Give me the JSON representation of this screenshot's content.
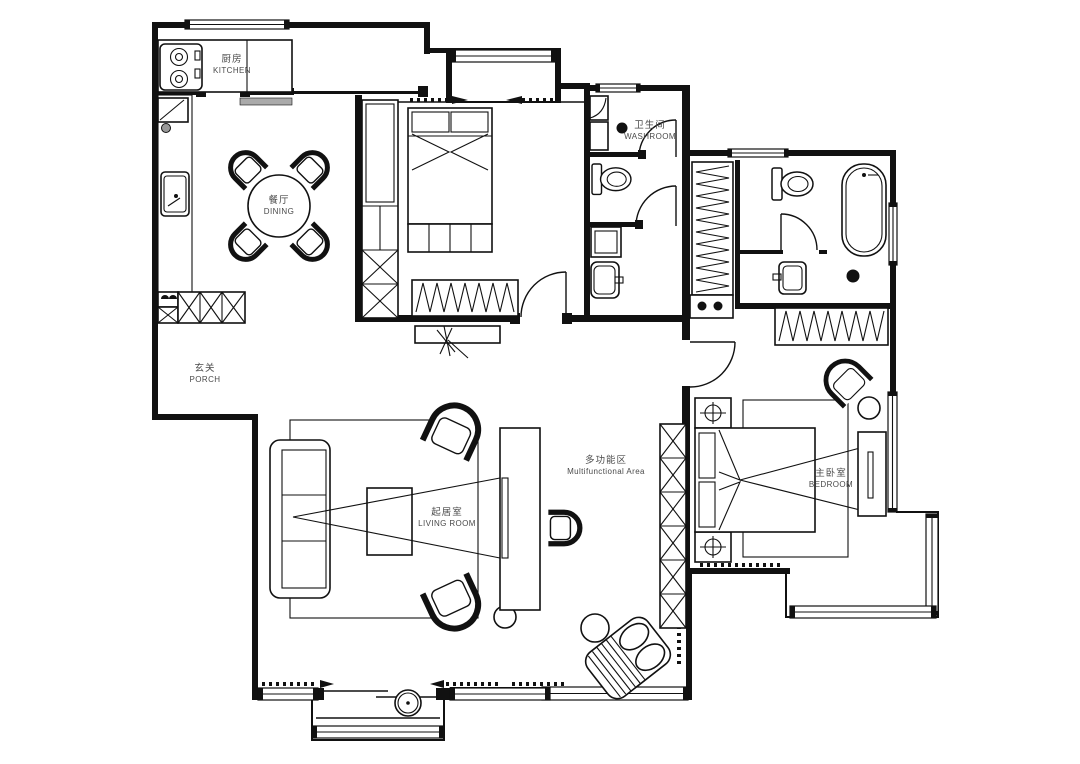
{
  "title": "apartment-floor-plan",
  "colors": {
    "line": "#111111",
    "label": "#4a4a4a",
    "background": "#ffffff",
    "counter_gray": "#aaaaaa"
  },
  "rooms": {
    "kitchen": {
      "zh": "厨房",
      "en": "KITCHEN"
    },
    "dining": {
      "zh": "餐厅",
      "en": "DINING"
    },
    "washroom": {
      "zh": "卫生间",
      "en": "WASHROOM"
    },
    "porch": {
      "zh": "玄关",
      "en": "PORCH"
    },
    "living_room": {
      "zh": "起居室",
      "en": "LIVING ROOM"
    },
    "multifunctional_area": {
      "zh": "多功能区",
      "en": "Multifunctional Area"
    },
    "master_bedroom": {
      "zh": "主卧室",
      "en": "BEDROOM"
    }
  }
}
